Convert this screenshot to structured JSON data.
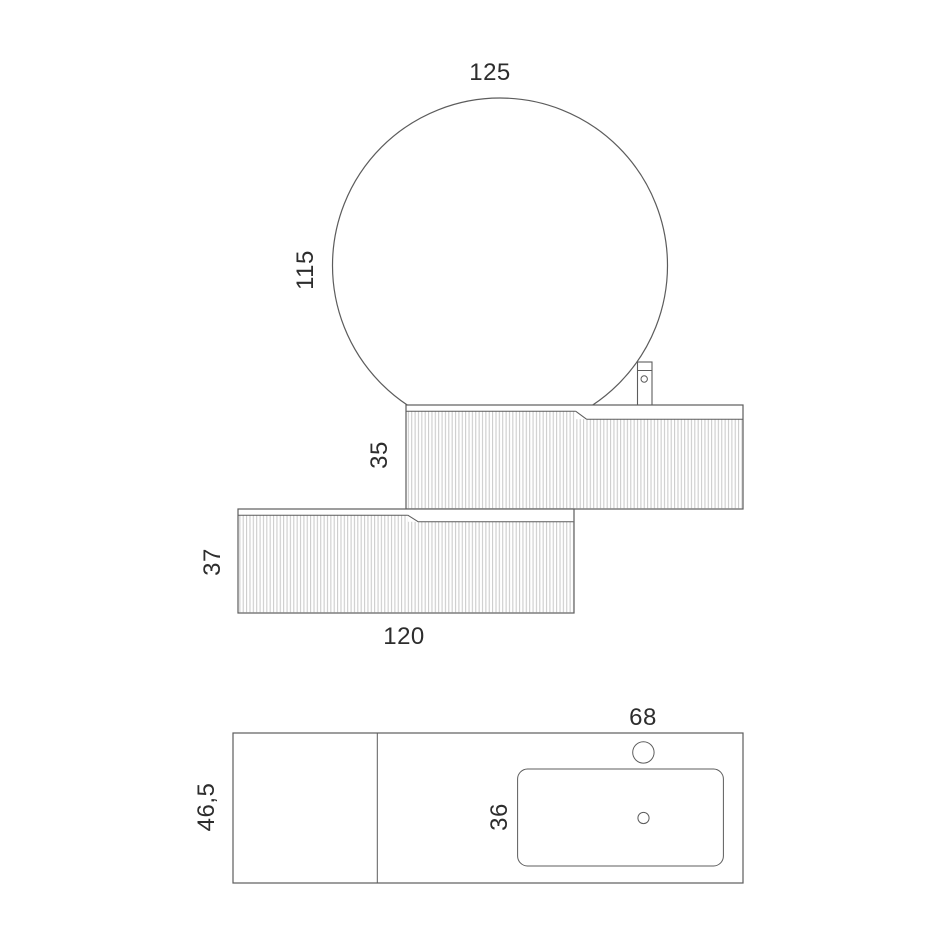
{
  "drawing": {
    "dimensions": {
      "mirror_width": "125",
      "mirror_height": "115",
      "basin_cabinet_height": "35",
      "drawer_cabinet_height": "37",
      "drawer_cabinet_width": "120",
      "countertop_depth": "46,5",
      "basin_depth": "36",
      "basin_section_width": "68"
    },
    "colors": {
      "outline": "#5c5c5c",
      "flute_line": "#c7c7c7",
      "label_text": "#2d2d2d",
      "background": "#ffffff"
    }
  }
}
